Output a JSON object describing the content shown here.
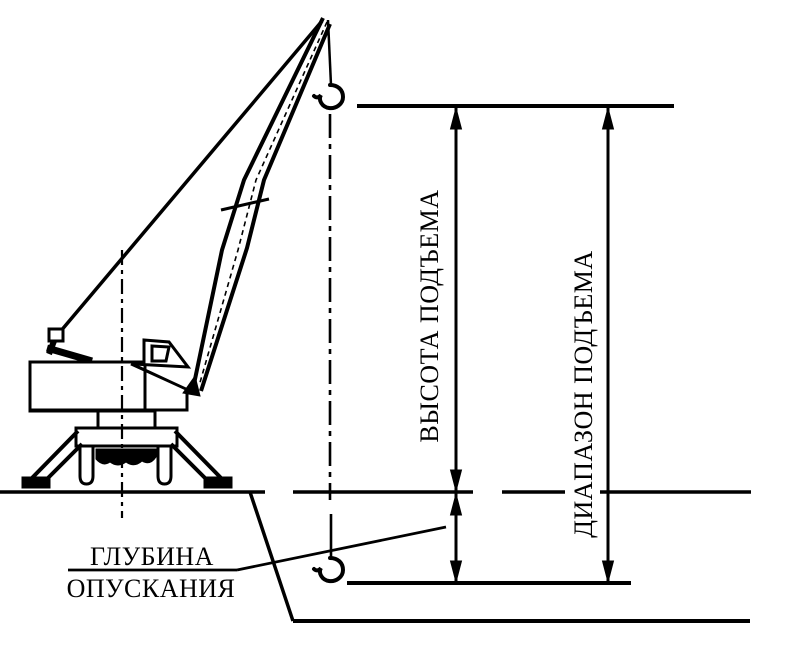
{
  "colors": {
    "background": "#ffffff",
    "line": "#000000",
    "text": "#000000"
  },
  "labels": {
    "lift_height": "ВЫСОТА ПОДЪЕМА",
    "lift_range": "ДИАПАЗОН ПОДЪЕМА",
    "lowering_depth": {
      "line1": "ГЛУБИНА",
      "line2": "ОПУСКАНИЯ"
    }
  },
  "icons": {
    "upper_hook": "crane-hook-icon",
    "lower_hook": "crane-hook-icon"
  }
}
